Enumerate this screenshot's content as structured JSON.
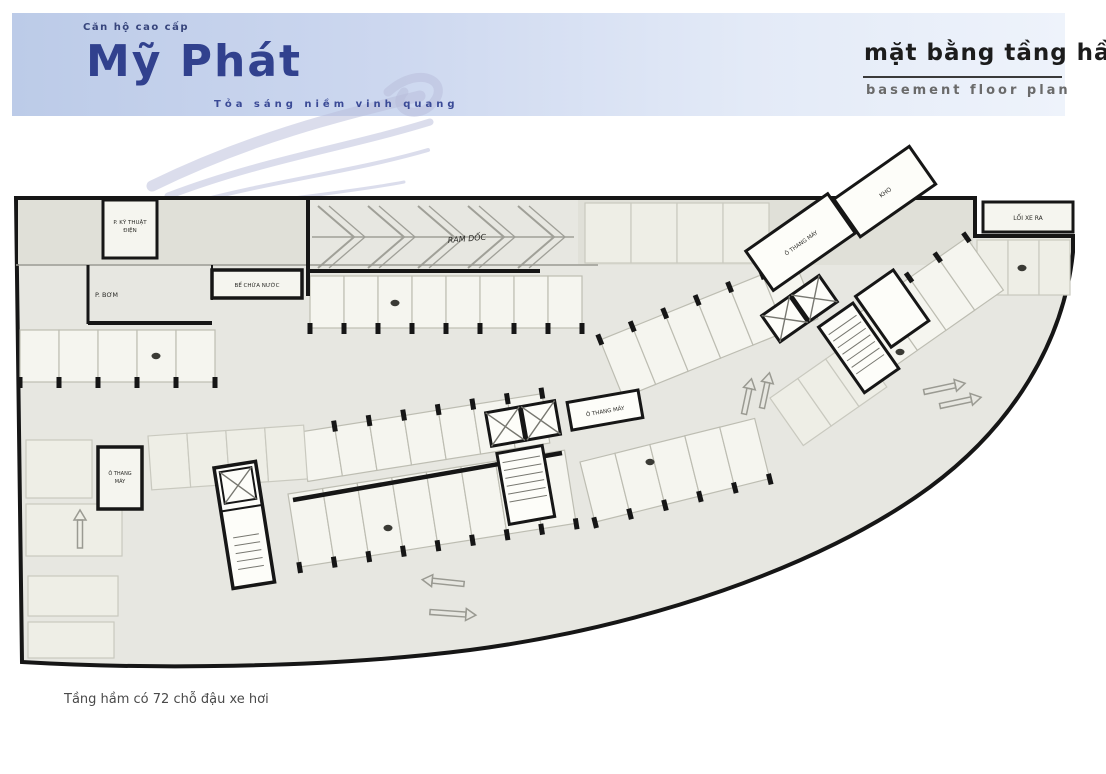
{
  "header": {
    "pre_title": "Căn hộ cao cấp",
    "brand": "Mỹ Phát",
    "tagline": "Tỏa sáng niềm vinh quang",
    "plan_title_vi": "Mặt bằng tầng hầm",
    "plan_title_en": "Basement floor plan"
  },
  "caption": {
    "text": "Tầng hầm có 72 chỗ đậu xe hơi"
  },
  "colors": {
    "banner_left": "#bccbe8",
    "banner_right": "#eef3fb",
    "brand_navy": "#31418e",
    "plan_fill": "#e7e7e1",
    "band_fill": "#e0e0d8",
    "stall_fill": "#f5f5ef",
    "stall_faint_fill": "#eeeee6",
    "stall_stroke": "#bdbdb2",
    "wall": "#161616",
    "hatch": "#a0a098",
    "arrow": "#9a9a92",
    "car": "#3a3a35"
  },
  "plan": {
    "labels": {
      "electrical_room_line1": "P. KỸ THUẬT",
      "electrical_room_line2": "ĐIỆN",
      "pump_room": "P. BƠM",
      "water_tank": "BỂ CHỨA NƯỚC",
      "ramp": "RAM DỐC",
      "exit_box": "LỐI XE RA",
      "elevator_left_line1": "Ô THANG",
      "elevator_left_line2": "MÁY",
      "elevator_center": "Ô THANG MÁY",
      "elevator_right": "Ô THANG MÁY",
      "storage": "KHO"
    },
    "parking_groups": [
      {
        "x": 310,
        "y": 276,
        "w": 34,
        "h": 52,
        "count": 8,
        "angle": 0,
        "columns": "bottom",
        "faint": false
      },
      {
        "x": 20,
        "y": 330,
        "w": 39,
        "h": 52,
        "count": 5,
        "angle": 0,
        "columns": "bottom",
        "faint": false
      },
      {
        "x": 585,
        "y": 203,
        "w": 46,
        "h": 60,
        "count": 4,
        "angle": 0,
        "columns": "none",
        "faint": true
      },
      {
        "x": 977,
        "y": 240,
        "w": 31,
        "h": 55,
        "count": 3,
        "angle": 0,
        "columns": "none",
        "faint": true
      },
      {
        "x": 300,
        "y": 432,
        "w": 35,
        "h": 50,
        "count": 7,
        "angle": -9,
        "columns": "top",
        "faint": false
      },
      {
        "x": 288,
        "y": 494,
        "w": 35,
        "h": 74,
        "count": 8,
        "angle": -9,
        "columns": "bottom",
        "faint": false
      },
      {
        "x": 148,
        "y": 436,
        "w": 39,
        "h": 54,
        "count": 4,
        "angle": -4,
        "columns": "none",
        "faint": true
      },
      {
        "x": 600,
        "y": 340,
        "w": 35,
        "h": 62,
        "count": 6,
        "angle": -22,
        "columns": "top",
        "faint": false
      },
      {
        "x": 580,
        "y": 462,
        "w": 36,
        "h": 62,
        "count": 5,
        "angle": -14,
        "columns": "bottom",
        "faint": false
      },
      {
        "x": 852,
        "y": 318,
        "w": 35,
        "h": 64,
        "count": 4,
        "angle": -35,
        "columns": "top",
        "faint": false
      },
      {
        "x": 770,
        "y": 398,
        "w": 34,
        "h": 58,
        "count": 3,
        "angle": -35,
        "columns": "none",
        "faint": true
      }
    ],
    "free_stalls": [
      {
        "x": 26,
        "y": 440,
        "w": 66,
        "h": 58
      },
      {
        "x": 26,
        "y": 504,
        "w": 96,
        "h": 52
      },
      {
        "x": 28,
        "y": 576,
        "w": 90,
        "h": 40
      },
      {
        "x": 28,
        "y": 622,
        "w": 86,
        "h": 36
      }
    ],
    "cars": [
      {
        "x": 395,
        "y": 303
      },
      {
        "x": 156,
        "y": 356
      },
      {
        "x": 388,
        "y": 528
      },
      {
        "x": 650,
        "y": 462
      },
      {
        "x": 1022,
        "y": 268
      },
      {
        "x": 900,
        "y": 352
      }
    ],
    "arrows": [
      {
        "x": 80,
        "y": 548,
        "dir": -90,
        "len": 38
      },
      {
        "x": 744,
        "y": 414,
        "dir": -78,
        "len": 36
      },
      {
        "x": 762,
        "y": 408,
        "dir": -78,
        "len": 36
      },
      {
        "x": 924,
        "y": 392,
        "dir": -12,
        "len": 42
      },
      {
        "x": 940,
        "y": 406,
        "dir": -12,
        "len": 42
      },
      {
        "x": 464,
        "y": 584,
        "dir": 186,
        "len": 42
      },
      {
        "x": 430,
        "y": 612,
        "dir": 4,
        "len": 46
      }
    ],
    "ramp_chevron_xs": [
      318,
      368,
      418,
      468,
      518
    ]
  }
}
